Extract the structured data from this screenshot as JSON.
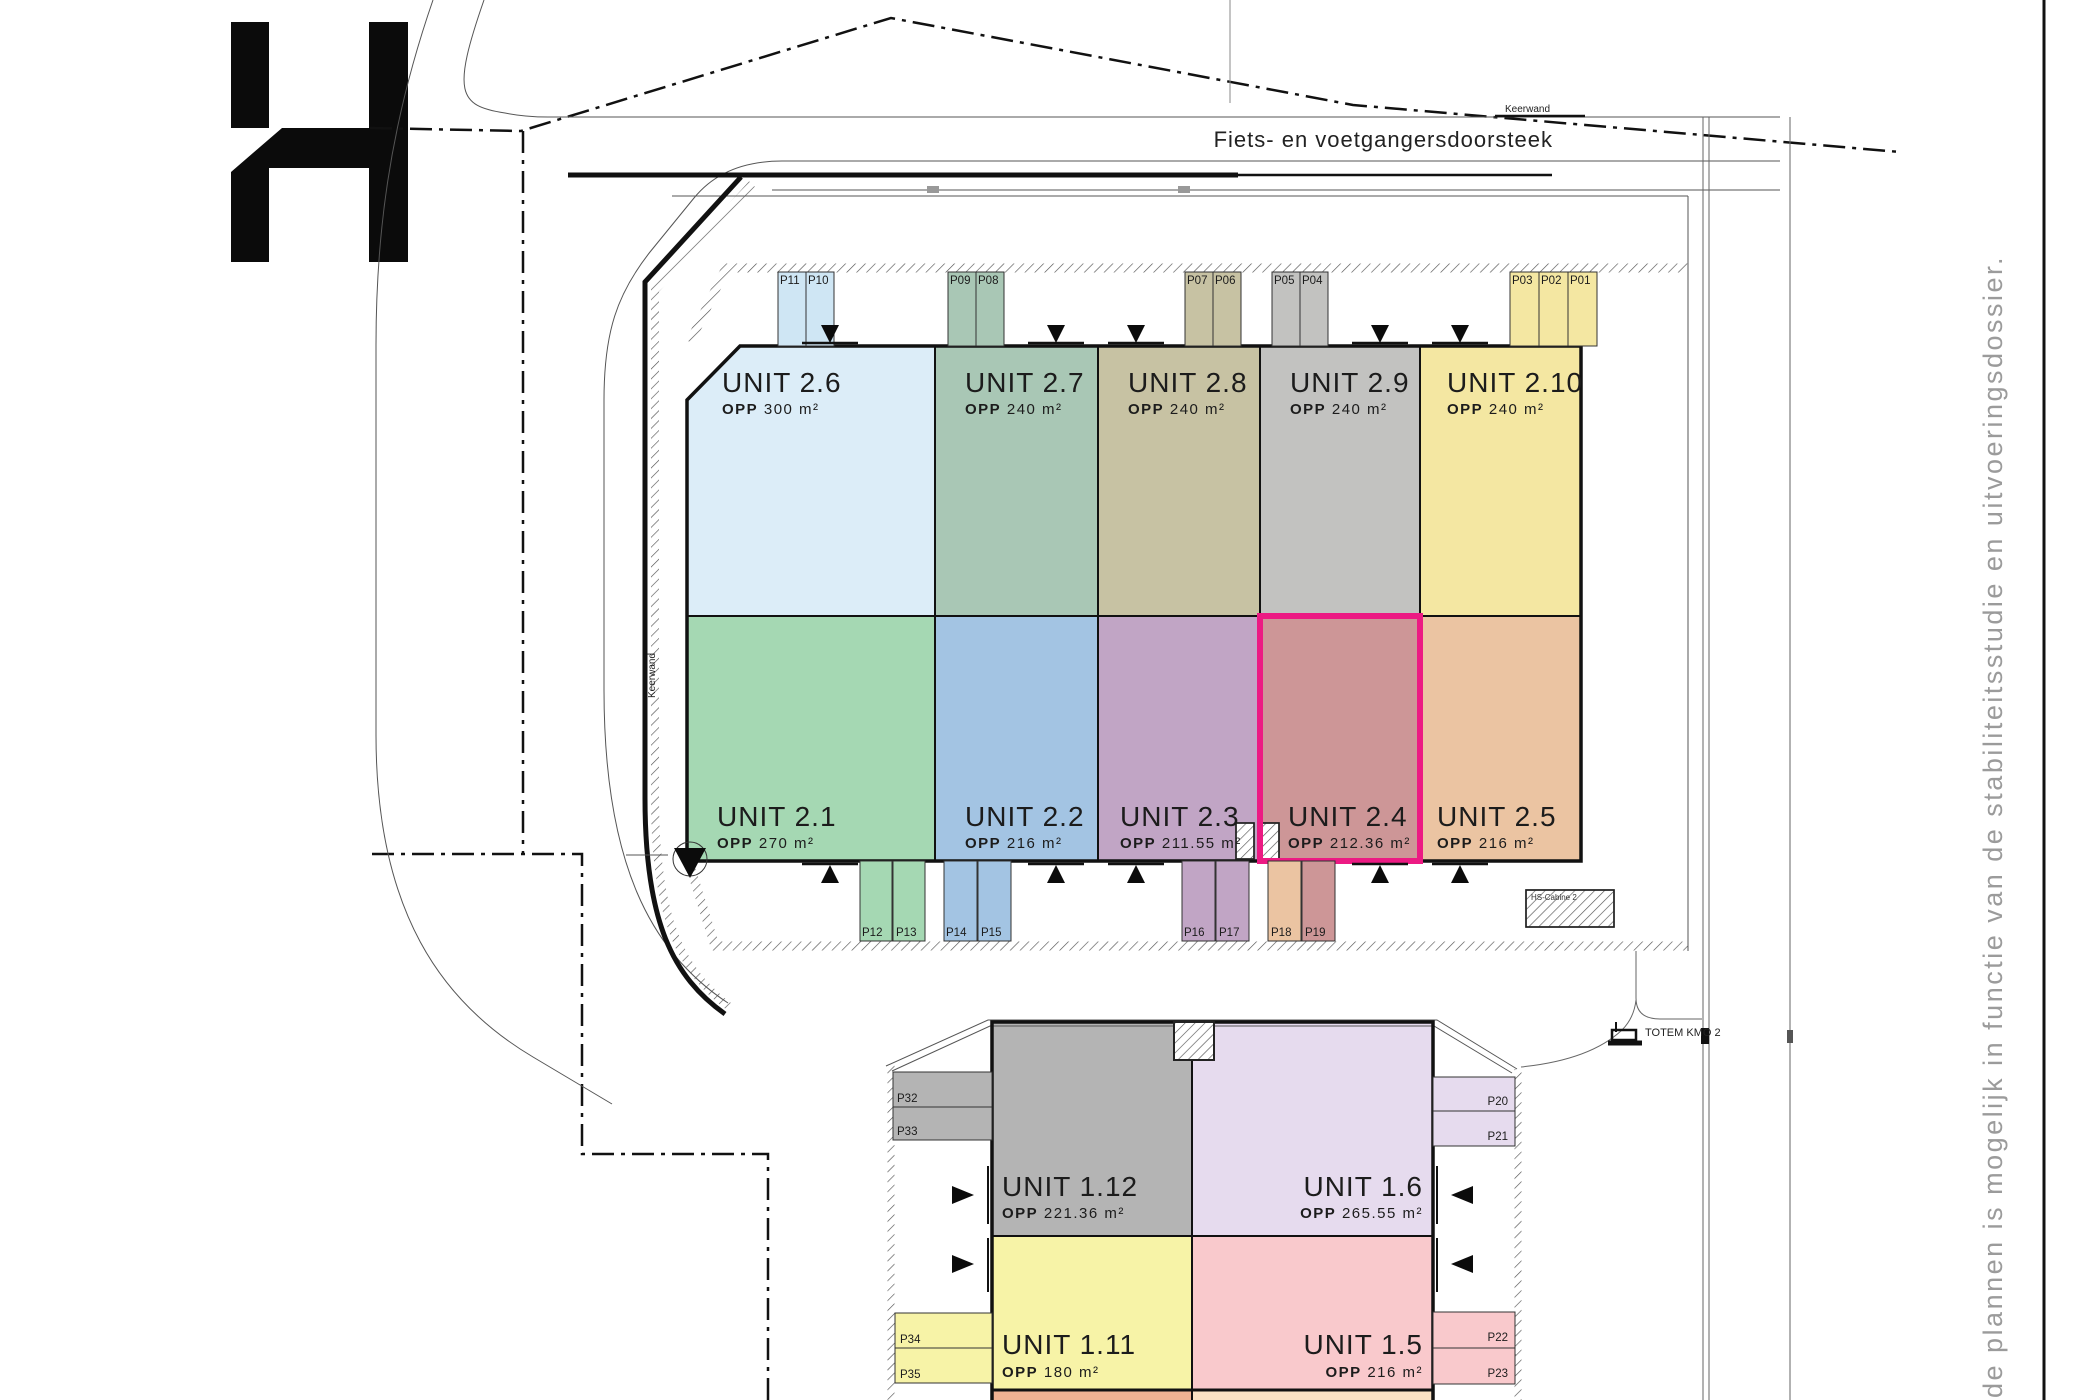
{
  "logo": {
    "letter": "H"
  },
  "labels": {
    "opp": "OPP"
  },
  "annotations": {
    "corridor": "Fiets- en voetgangersdoorsteek",
    "keerwand_top": "Keerwand",
    "keerwand_left": "Keerwand",
    "hs_cabine": "HS-Cabine 2",
    "totem": "TOTEM KMO 2",
    "disclaimer": "de plannen is mogelijk in functie van de stabiliteitsstudie en uitvoeringsdossier."
  },
  "colors": {
    "highlight": "#ec1a83",
    "partial_left": "#f0b292",
    "partial_right": "#fbe2c4"
  },
  "building2_top": [
    {
      "name": "UNIT 2.6",
      "opp": "300 m²",
      "color": "#dcedf8"
    },
    {
      "name": "UNIT 2.7",
      "opp": "240 m²",
      "color": "#a9c7b5"
    },
    {
      "name": "UNIT 2.8",
      "opp": "240 m²",
      "color": "#c7c2a3"
    },
    {
      "name": "UNIT 2.9",
      "opp": "240 m²",
      "color": "#c2c2c0"
    },
    {
      "name": "UNIT 2.10",
      "opp": "240 m²",
      "color": "#f4e7a2"
    }
  ],
  "building2_bottom": [
    {
      "name": "UNIT 2.1",
      "opp": "270 m²",
      "color": "#a5d8b3"
    },
    {
      "name": "UNIT 2.2",
      "opp": "216 m²",
      "color": "#a3c4e3"
    },
    {
      "name": "UNIT 2.3",
      "opp": "211.55 m²",
      "color": "#c1a5c5"
    },
    {
      "name": "UNIT 2.4",
      "opp": "212.36 m²",
      "color": "#cd9697",
      "highlighted": true
    },
    {
      "name": "UNIT 2.5",
      "opp": "216 m²",
      "color": "#ebc4a2"
    }
  ],
  "building1": [
    {
      "name": "UNIT 1.12",
      "opp": "221.36 m²",
      "color": "#b4b4b4"
    },
    {
      "name": "UNIT 1.6",
      "opp": "265.55 m²",
      "color": "#e6dbee"
    },
    {
      "name": "UNIT 1.11",
      "opp": "180 m²",
      "color": "#f7f3a7"
    },
    {
      "name": "UNIT 1.5",
      "opp": "216 m²",
      "color": "#f9c9cc"
    }
  ],
  "parking": {
    "top": [
      "P11",
      "P10",
      "P09",
      "P08",
      "P07",
      "P06",
      "P05",
      "P04",
      "P03",
      "P02",
      "P01"
    ],
    "bottom": [
      "P12",
      "P13",
      "P14",
      "P15",
      "P16",
      "P17",
      "P18",
      "P19"
    ],
    "b1_left": [
      "P32",
      "P33",
      "P34",
      "P35"
    ],
    "b1_right": [
      "P20",
      "P21",
      "P22",
      "P23"
    ]
  }
}
